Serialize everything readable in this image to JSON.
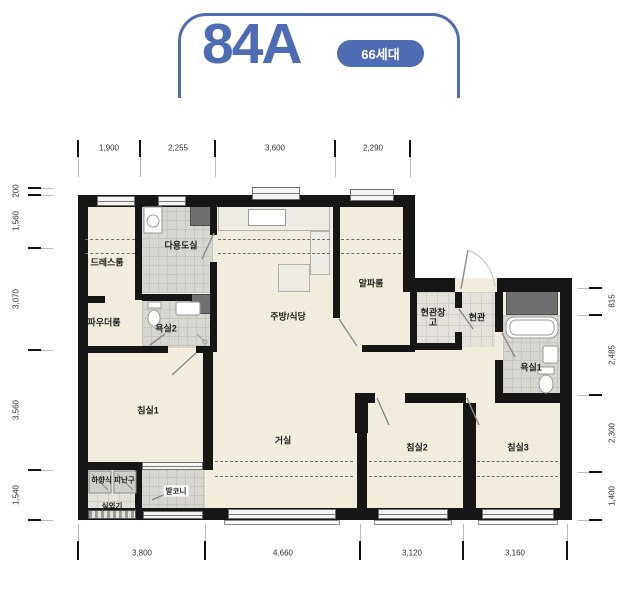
{
  "header": {
    "title": "84A",
    "badge": "66세대"
  },
  "colors": {
    "accent": "#4e6cb3",
    "wall": "#161616",
    "floor": "#f1ecdb"
  },
  "rooms": [
    {
      "id": "dressroom",
      "label": "드레스룸"
    },
    {
      "id": "utility",
      "label": "다용도실"
    },
    {
      "id": "powder",
      "label": "파우더룸"
    },
    {
      "id": "bath2",
      "label": "욕실2"
    },
    {
      "id": "kitchen",
      "label": "주방/식당"
    },
    {
      "id": "alpha",
      "label": "알파룸"
    },
    {
      "id": "entry-storage",
      "label": "현관창고"
    },
    {
      "id": "entry",
      "label": "현관"
    },
    {
      "id": "bath1",
      "label": "욕실1"
    },
    {
      "id": "bed1",
      "label": "침실1"
    },
    {
      "id": "living",
      "label": "거실"
    },
    {
      "id": "bed2",
      "label": "침실2"
    },
    {
      "id": "bed3",
      "label": "침실3"
    },
    {
      "id": "hatch",
      "label": "하향식 피난구"
    },
    {
      "id": "outdoor-unit",
      "label": "실외기"
    },
    {
      "id": "balcony",
      "label": "발코니"
    }
  ],
  "dimensions": {
    "top": [
      "1,900",
      "2,255",
      "3,600",
      "2,290"
    ],
    "bottom": [
      "3,800",
      "4,660",
      "3,120",
      "3,160"
    ],
    "left": [
      "200",
      "1,560",
      "3,070",
      "3,560",
      "1,540"
    ],
    "right": [
      "815",
      "2,485",
      "2,300",
      "1,400"
    ]
  }
}
